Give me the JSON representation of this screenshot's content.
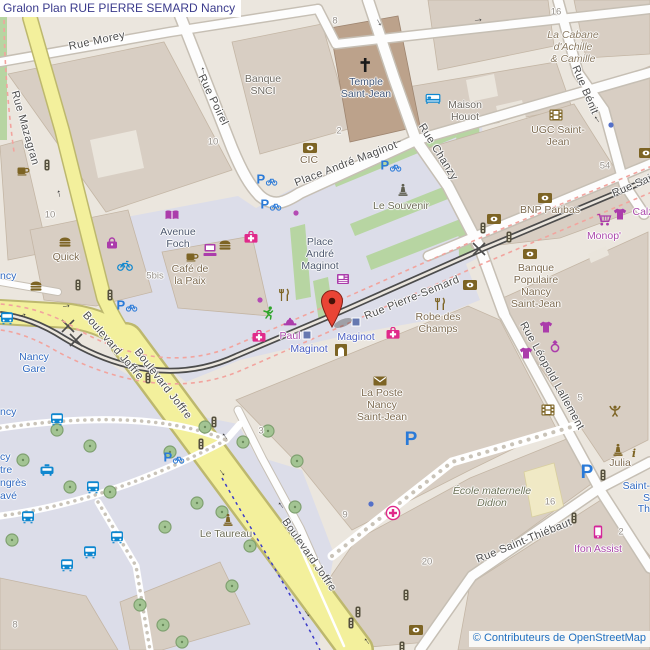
{
  "title": "Gralon Plan RUE PIERRE SEMARD Nancy",
  "attribution": "© Contributeurs de OpenStreetMap",
  "colors": {
    "road_yellow": "#f3f09c",
    "road_white": "#fdfdfd",
    "pedestrian": "#dcdde9",
    "building": "#d8cec3",
    "temple_building": "#bca28b",
    "school_building": "#f0e9c5",
    "grass": "#b7d5a2",
    "railway": "#4c4c4c",
    "route_dash_pink": "#f2a49e",
    "route_dash_blue": "#3c3cc8",
    "marker_red": "#e94435",
    "shop_purple": "#ab3cab",
    "health_pink": "#e02a8a",
    "amenity_brown": "#7d6424",
    "transport_blue": "#0f87cf",
    "parking_blue": "#2a7ad8"
  },
  "map": {
    "street_labels": [
      {
        "text": "Rue Morey",
        "x": 97,
        "y": 41,
        "rot": -12
      },
      {
        "text": "Rue Mazagran",
        "x": 25,
        "y": 128,
        "rot": 74
      },
      {
        "text": "Rue Poirel",
        "x": 213,
        "y": 100,
        "rot": 64
      },
      {
        "text": "Place André Maginot",
        "x": 346,
        "y": 164,
        "rot": -21
      },
      {
        "text": "Rue Chanzy",
        "x": 438,
        "y": 152,
        "rot": 58
      },
      {
        "text": "Rue Bénit",
        "x": 585,
        "y": 90,
        "rot": 67
      },
      {
        "text": "Rue Pierre-Semard",
        "x": 412,
        "y": 298,
        "rot": -22
      },
      {
        "text": "Rue Sai",
        "x": 632,
        "y": 186,
        "rot": -23
      },
      {
        "text": "Boulevard Joffre",
        "x": 113,
        "y": 346,
        "rot": 49
      },
      {
        "text": "Boulevard Joffre",
        "x": 163,
        "y": 384,
        "rot": 52
      },
      {
        "text": "Boulevard Joffre",
        "x": 309,
        "y": 555,
        "rot": 55
      },
      {
        "text": "Rue Saint-Thiébaut",
        "x": 524,
        "y": 541,
        "rot": -22
      },
      {
        "text": "Rue Léopold Lallement",
        "x": 552,
        "y": 376,
        "rot": 61
      }
    ],
    "poi_labels": [
      {
        "text": "Banque\nSNCI",
        "x": 263,
        "y": 86,
        "kind": "gray"
      },
      {
        "text": "Temple\nSaint-Jean",
        "x": 366,
        "y": 89,
        "kind": "temple"
      },
      {
        "text": "Maison\nHouot",
        "x": 465,
        "y": 112,
        "kind": "gray"
      },
      {
        "text": "UGC Saint-\nJean",
        "x": 558,
        "y": 137,
        "kind": "brown"
      },
      {
        "text": "La Cabane\nd'Achille\n& Camille",
        "x": 573,
        "y": 48,
        "kind": "cabane"
      },
      {
        "text": "Avenue\nFoch",
        "x": 178,
        "y": 239,
        "kind": "place"
      },
      {
        "text": "Quick",
        "x": 66,
        "y": 258,
        "kind": "brown"
      },
      {
        "text": "Café de\nla Paix",
        "x": 190,
        "y": 276,
        "kind": "brown"
      },
      {
        "text": "Place\nAndré\nMaginot",
        "x": 320,
        "y": 255,
        "kind": "place"
      },
      {
        "text": "Le Souvenir",
        "x": 401,
        "y": 207,
        "kind": "memorial"
      },
      {
        "text": "CIC",
        "x": 309,
        "y": 161,
        "kind": "brown"
      },
      {
        "text": "BNP Paribas",
        "x": 550,
        "y": 211,
        "kind": "brown"
      },
      {
        "text": "Monop'",
        "x": 604,
        "y": 237,
        "kind": "purple"
      },
      {
        "text": "Calz",
        "x": 643,
        "y": 213,
        "kind": "purple"
      },
      {
        "text": "Banque\nPopulaire\nNancy\nSaint-Jean",
        "x": 536,
        "y": 287,
        "kind": "brown"
      },
      {
        "text": "Robe des\nChamps",
        "x": 438,
        "y": 324,
        "kind": "brown"
      },
      {
        "text": "Paul",
        "x": 290,
        "y": 337,
        "kind": "purple"
      },
      {
        "text": "Maginot",
        "x": 356,
        "y": 338,
        "kind": "transit"
      },
      {
        "text": "Maginot",
        "x": 309,
        "y": 350,
        "kind": "transit"
      },
      {
        "text": "La Poste\nNancy\nSaint-Jean",
        "x": 382,
        "y": 406,
        "kind": "brown"
      },
      {
        "text": "École maternelle\nDidion",
        "x": 492,
        "y": 498,
        "kind": "school"
      },
      {
        "text": "Julia",
        "x": 620,
        "y": 464,
        "kind": "brown"
      },
      {
        "text": "Le Taureau",
        "x": 226,
        "y": 535,
        "kind": "memorial"
      },
      {
        "text": "Nancy\nGare",
        "x": 34,
        "y": 364,
        "kind": "station"
      },
      {
        "text": "Ifon Assist",
        "x": 598,
        "y": 550,
        "kind": "purple"
      }
    ],
    "edge_fragments": [
      {
        "text": "ncy",
        "x": 0,
        "y": 277,
        "kind": "station",
        "anchor": "left"
      },
      {
        "text": "ncy",
        "x": 0,
        "y": 413,
        "kind": "station",
        "anchor": "left"
      },
      {
        "text": "cy",
        "x": 0,
        "y": 458,
        "kind": "station",
        "anchor": "left"
      },
      {
        "text": "tre",
        "x": 0,
        "y": 471,
        "kind": "station",
        "anchor": "left"
      },
      {
        "text": "ngrès",
        "x": 0,
        "y": 484,
        "kind": "station",
        "anchor": "left"
      },
      {
        "text": "avé",
        "x": 0,
        "y": 497,
        "kind": "station",
        "anchor": "left"
      },
      {
        "text": "Saint-",
        "x": 650,
        "y": 487,
        "kind": "station",
        "anchor": "right"
      },
      {
        "text": "S",
        "x": 650,
        "y": 499,
        "kind": "station",
        "anchor": "right"
      },
      {
        "text": "Th",
        "x": 650,
        "y": 510,
        "kind": "station",
        "anchor": "right"
      }
    ],
    "house_numbers": [
      {
        "text": "10",
        "x": 213,
        "y": 142
      },
      {
        "text": "10",
        "x": 50,
        "y": 215
      },
      {
        "text": "8",
        "x": 335,
        "y": 21
      },
      {
        "text": "16",
        "x": 556,
        "y": 12
      },
      {
        "text": "2",
        "x": 339,
        "y": 131
      },
      {
        "text": "54",
        "x": 605,
        "y": 166
      },
      {
        "text": "16",
        "x": 550,
        "y": 502
      },
      {
        "text": "5",
        "x": 580,
        "y": 398
      },
      {
        "text": "2",
        "x": 621,
        "y": 532
      },
      {
        "text": "3",
        "x": 261,
        "y": 431
      },
      {
        "text": "9",
        "x": 345,
        "y": 515
      },
      {
        "text": "20",
        "x": 427,
        "y": 562
      },
      {
        "text": "8",
        "x": 15,
        "y": 625
      },
      {
        "text": "5bis",
        "x": 155,
        "y": 276
      }
    ],
    "icons": [
      {
        "name": "tree",
        "x": 57,
        "y": 430
      },
      {
        "name": "tree",
        "x": 90,
        "y": 446
      },
      {
        "name": "tree",
        "x": 23,
        "y": 460
      },
      {
        "name": "tree",
        "x": 70,
        "y": 487
      },
      {
        "name": "tree",
        "x": 110,
        "y": 492
      },
      {
        "name": "tree",
        "x": 12,
        "y": 540
      },
      {
        "name": "tree",
        "x": 205,
        "y": 427
      },
      {
        "name": "tree",
        "x": 170,
        "y": 452
      },
      {
        "name": "tree",
        "x": 243,
        "y": 442
      },
      {
        "name": "tree",
        "x": 268,
        "y": 431
      },
      {
        "name": "tree",
        "x": 297,
        "y": 461
      },
      {
        "name": "tree",
        "x": 222,
        "y": 512
      },
      {
        "name": "tree",
        "x": 197,
        "y": 503
      },
      {
        "name": "tree",
        "x": 165,
        "y": 527
      },
      {
        "name": "tree",
        "x": 250,
        "y": 546
      },
      {
        "name": "tree",
        "x": 232,
        "y": 586
      },
      {
        "name": "tree",
        "x": 140,
        "y": 605
      },
      {
        "name": "tree",
        "x": 163,
        "y": 625
      },
      {
        "name": "tree",
        "x": 182,
        "y": 642
      },
      {
        "name": "tree",
        "x": 295,
        "y": 507
      },
      {
        "name": "bank",
        "x": 310,
        "y": 148
      },
      {
        "name": "bank",
        "x": 545,
        "y": 198
      },
      {
        "name": "bank",
        "x": 494,
        "y": 219
      },
      {
        "name": "bank",
        "x": 530,
        "y": 254
      },
      {
        "name": "bank",
        "x": 470,
        "y": 285
      },
      {
        "name": "bank",
        "x": 416,
        "y": 630
      },
      {
        "name": "bank",
        "x": 646,
        "y": 153
      },
      {
        "name": "burger",
        "x": 65,
        "y": 242
      },
      {
        "name": "burger",
        "x": 36,
        "y": 286
      },
      {
        "name": "burger",
        "x": 225,
        "y": 245
      },
      {
        "name": "coffee",
        "x": 23,
        "y": 170
      },
      {
        "name": "coffee",
        "x": 192,
        "y": 256
      },
      {
        "name": "book",
        "x": 172,
        "y": 215
      },
      {
        "name": "purse",
        "x": 112,
        "y": 243
      },
      {
        "name": "first-aid",
        "x": 251,
        "y": 237
      },
      {
        "name": "first-aid",
        "x": 259,
        "y": 336
      },
      {
        "name": "first-aid",
        "x": 393,
        "y": 333
      },
      {
        "name": "clinic",
        "x": 393,
        "y": 513
      },
      {
        "name": "computer",
        "x": 210,
        "y": 250
      },
      {
        "name": "bicycle-rental",
        "x": 125,
        "y": 265
      },
      {
        "name": "restaurant",
        "x": 284,
        "y": 295
      },
      {
        "name": "restaurant",
        "x": 440,
        "y": 304
      },
      {
        "name": "runner",
        "x": 268,
        "y": 313
      },
      {
        "name": "hat",
        "x": 290,
        "y": 322
      },
      {
        "name": "shop-dot",
        "x": 296,
        "y": 213
      },
      {
        "name": "shop-dot",
        "x": 260,
        "y": 300
      },
      {
        "name": "poi-dot",
        "x": 611,
        "y": 125
      },
      {
        "name": "poi-dot",
        "x": 371,
        "y": 504
      },
      {
        "name": "hotel",
        "x": 433,
        "y": 99
      },
      {
        "name": "cinema",
        "x": 556,
        "y": 115
      },
      {
        "name": "cinema",
        "x": 548,
        "y": 410
      },
      {
        "name": "post",
        "x": 380,
        "y": 381
      },
      {
        "name": "memorial",
        "x": 403,
        "y": 190
      },
      {
        "name": "statue",
        "x": 228,
        "y": 520
      },
      {
        "name": "statue",
        "x": 618,
        "y": 450
      },
      {
        "name": "artwork",
        "x": 615,
        "y": 411
      },
      {
        "name": "information",
        "x": 634,
        "y": 453
      },
      {
        "name": "supermarket",
        "x": 604,
        "y": 220
      },
      {
        "name": "clothes",
        "x": 620,
        "y": 214
      },
      {
        "name": "clothes",
        "x": 546,
        "y": 327
      },
      {
        "name": "clothes",
        "x": 526,
        "y": 353
      },
      {
        "name": "jewelry",
        "x": 555,
        "y": 346
      },
      {
        "name": "phone",
        "x": 598,
        "y": 532
      },
      {
        "name": "bus",
        "x": 7,
        "y": 318
      },
      {
        "name": "bus",
        "x": 57,
        "y": 419
      },
      {
        "name": "bus",
        "x": 93,
        "y": 487
      },
      {
        "name": "bus",
        "x": 28,
        "y": 517
      },
      {
        "name": "bus",
        "x": 117,
        "y": 537
      },
      {
        "name": "bus",
        "x": 90,
        "y": 552
      },
      {
        "name": "bus",
        "x": 67,
        "y": 565
      },
      {
        "name": "taxi",
        "x": 47,
        "y": 470
      },
      {
        "name": "traffic-light",
        "x": 47,
        "y": 165
      },
      {
        "name": "traffic-light",
        "x": 78,
        "y": 285
      },
      {
        "name": "traffic-light",
        "x": 110,
        "y": 295
      },
      {
        "name": "traffic-light",
        "x": 148,
        "y": 378
      },
      {
        "name": "traffic-light",
        "x": 214,
        "y": 422
      },
      {
        "name": "traffic-light",
        "x": 201,
        "y": 444
      },
      {
        "name": "traffic-light",
        "x": 483,
        "y": 228
      },
      {
        "name": "traffic-light",
        "x": 509,
        "y": 237
      },
      {
        "name": "traffic-light",
        "x": 574,
        "y": 518
      },
      {
        "name": "traffic-light",
        "x": 603,
        "y": 475
      },
      {
        "name": "traffic-light",
        "x": 406,
        "y": 595
      },
      {
        "name": "traffic-light",
        "x": 358,
        "y": 612
      },
      {
        "name": "traffic-light",
        "x": 351,
        "y": 623
      },
      {
        "name": "traffic-light",
        "x": 402,
        "y": 647
      },
      {
        "name": "tram-stop",
        "x": 307,
        "y": 335
      },
      {
        "name": "tram-stop",
        "x": 356,
        "y": 322
      },
      {
        "name": "doorway",
        "x": 341,
        "y": 350
      },
      {
        "name": "newsagent",
        "x": 343,
        "y": 279
      },
      {
        "name": "temple-cross",
        "x": 365,
        "y": 65
      },
      {
        "name": "parking-bike",
        "x": 267,
        "y": 179
      },
      {
        "name": "parking-bike",
        "x": 271,
        "y": 204
      },
      {
        "name": "parking-bike",
        "x": 127,
        "y": 305
      },
      {
        "name": "parking-bike",
        "x": 391,
        "y": 165
      },
      {
        "name": "parking-bike",
        "x": 174,
        "y": 457
      },
      {
        "name": "parking",
        "x": 411,
        "y": 440
      },
      {
        "name": "parking",
        "x": 587,
        "y": 473
      },
      {
        "name": "oneway-arrow",
        "x": 202,
        "y": 71,
        "rot": -100
      },
      {
        "name": "oneway-arrow",
        "x": 58,
        "y": 194,
        "rot": -103
      },
      {
        "name": "oneway-arrow",
        "x": 478,
        "y": 19,
        "rot": -6
      },
      {
        "name": "oneway-arrow",
        "x": 398,
        "y": 143,
        "rot": 162
      },
      {
        "name": "oneway-arrow",
        "x": 380,
        "y": 22,
        "rot": 62
      },
      {
        "name": "oneway-arrow",
        "x": 596,
        "y": 120,
        "rot": -125
      },
      {
        "name": "oneway-arrow",
        "x": 224,
        "y": 437,
        "rot": -128
      },
      {
        "name": "oneway-arrow",
        "x": 223,
        "y": 472,
        "rot": 52
      },
      {
        "name": "oneway-arrow",
        "x": 280,
        "y": 506,
        "rot": -128
      },
      {
        "name": "oneway-arrow",
        "x": 308,
        "y": 613,
        "rot": 52
      },
      {
        "name": "oneway-arrow",
        "x": 366,
        "y": 642,
        "rot": -128
      },
      {
        "name": "oneway-arrow",
        "x": 22,
        "y": 314,
        "rot": -15
      },
      {
        "name": "oneway-arrow",
        "x": 66,
        "y": 305,
        "rot": -8
      }
    ],
    "marker": {
      "x": 332,
      "y": 327
    }
  }
}
